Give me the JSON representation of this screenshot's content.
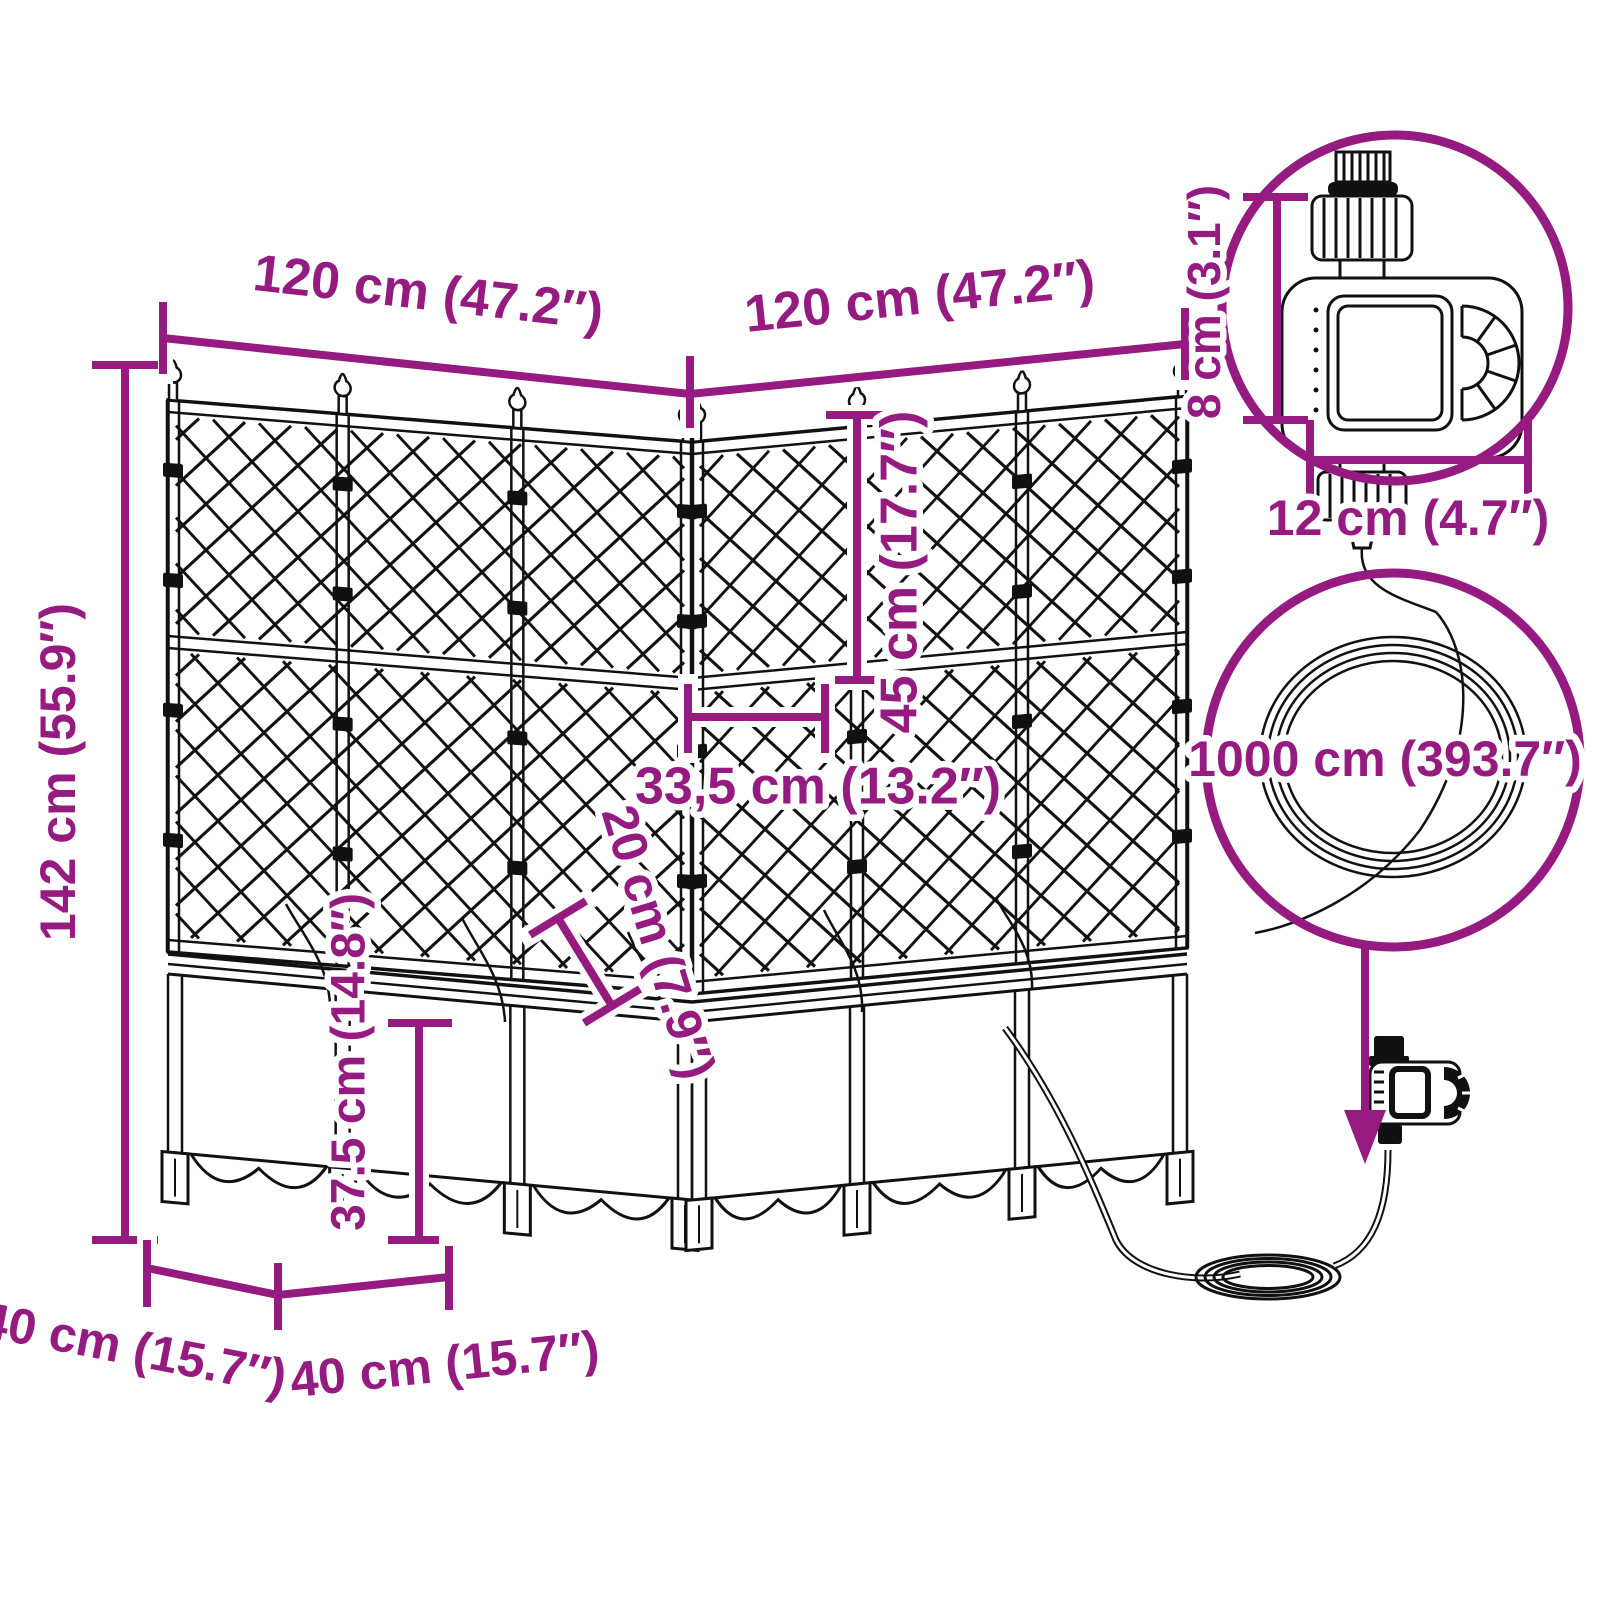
{
  "colors": {
    "accent": "#951b81",
    "ink": "#111111",
    "background": "#ffffff"
  },
  "icons": {
    "arrow_down_icon": "filled-triangle-down"
  },
  "dimensions": {
    "width_left": "120 cm (47.2″)",
    "width_right": "120 cm (47.2″)",
    "height_total": "142 cm (55.9″)",
    "trellis_tier_height": "45 cm (17.7″)",
    "box_width": "33,5 cm (13.2″)",
    "box_inner_depth": "20 cm (7.9″)",
    "planter_height": "37.5 cm (14.8″)",
    "depth_left": "40 cm (15.7″)",
    "depth_right": "40 cm (15.7″)",
    "timer_height": "8 cm (3.1″)",
    "timer_width": "12 cm (4.7″)",
    "hose_length": "1000 cm (393.7″)"
  }
}
